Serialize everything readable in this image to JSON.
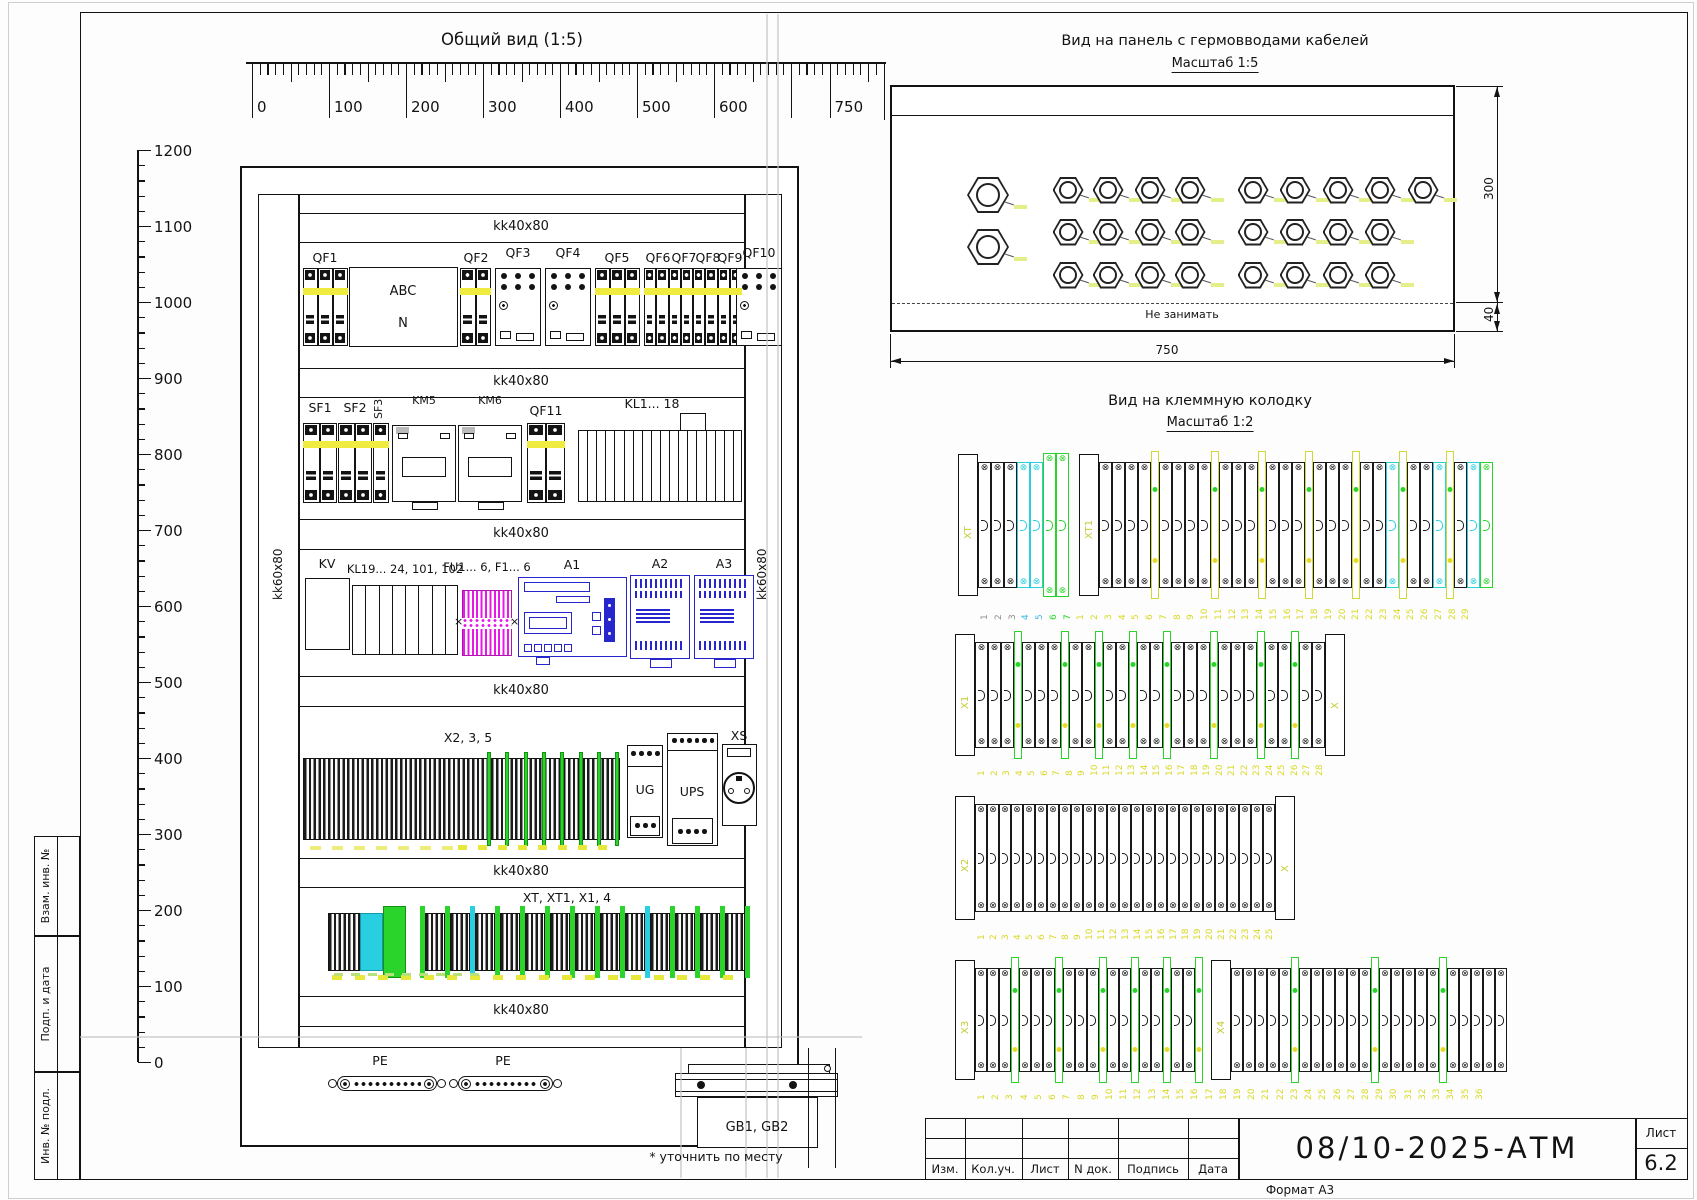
{
  "gv": {
    "title": "Общий вид (1:5)",
    "channel_h": "kk40x80",
    "channel_v": "kk60x80",
    "h_ruler": [
      "0",
      "100",
      "200",
      "300",
      "400",
      "500",
      "600",
      "750"
    ],
    "v_ruler": [
      "1200",
      "1100",
      "1000",
      "900",
      "800",
      "700",
      "600",
      "500",
      "400",
      "300",
      "200",
      "100",
      "0"
    ],
    "qf1": "QF1",
    "qf2": "QF2",
    "qf3": "QF3",
    "qf4": "QF4",
    "qf5": "QF5",
    "qf6": "QF6",
    "qf7": "QF7",
    "qf8": "QF8",
    "qf9": "QF9",
    "qf10": "QF10",
    "qf11": "QF11",
    "phase_a": "ABC",
    "phase_n": "N",
    "sf1": "SF1",
    "sf2": "SF2",
    "sf3": "SF3",
    "km5": "KM5",
    "km6": "KM6",
    "kl_1_18": "KL1... 18",
    "kv": "KV",
    "kl_19": "KL19... 24, 101, 102",
    "fu": "FU1... 6, F1... 6",
    "a1": "A1",
    "a2": "A2",
    "a3": "A3",
    "x235": "X2, 3, 5",
    "ug": "UG",
    "ups": "UPS",
    "xs": "XS",
    "xt_row": "XT, XT1, X1, 4",
    "pe": "PE",
    "gb": "GB1, GB2",
    "footnote": "* уточнить по месту"
  },
  "gland": {
    "title": "Вид на панель с гермовводами кабелей",
    "scale": "Масштаб 1:5",
    "keep_out": "Не занимать",
    "dim_width": "750",
    "dim_height": "300",
    "dim_flange": "40",
    "left_column_glands": 2,
    "middle_grid": {
      "cols": 4,
      "rows": 3
    },
    "right_grid_rows": [
      5,
      4,
      4
    ]
  },
  "tv": {
    "title": "Вид на клеммную колодку",
    "scale": "Масштаб 1:2",
    "strips": [
      {
        "name": "XT / XT1",
        "div_color": "#cfd83a",
        "tokens": [
          {
            "k": "bracket",
            "t": "XT"
          },
          {
            "k": "cells",
            "c": "black",
            "n": 3
          },
          {
            "k": "cells",
            "c": "cyan",
            "n": 2
          },
          {
            "k": "cells",
            "c": "green",
            "n": 2,
            "tall": true
          },
          {
            "k": "gap",
            "w": 10
          },
          {
            "k": "bracket",
            "t": "XT1"
          },
          {
            "k": "cells",
            "c": "black",
            "n": 4
          },
          {
            "k": "div"
          },
          {
            "k": "cells",
            "c": "black",
            "n": 4
          },
          {
            "k": "div"
          },
          {
            "k": "cells",
            "c": "black",
            "n": 3
          },
          {
            "k": "div"
          },
          {
            "k": "cells",
            "c": "black",
            "n": 3
          },
          {
            "k": "div"
          },
          {
            "k": "cells",
            "c": "black",
            "n": 3
          },
          {
            "k": "div"
          },
          {
            "k": "cells",
            "c": "black",
            "n": 2
          },
          {
            "k": "cells",
            "c": "cyan",
            "n": 1
          },
          {
            "k": "div"
          },
          {
            "k": "cells",
            "c": "black",
            "n": 2
          },
          {
            "k": "cells",
            "c": "cyan",
            "n": 1
          },
          {
            "k": "div"
          },
          {
            "k": "cells",
            "c": "black",
            "n": 1
          },
          {
            "k": "cells",
            "c": "cyan",
            "n": 1
          },
          {
            "k": "cells",
            "c": "green",
            "n": 1
          }
        ],
        "numbers": [
          {
            "from": 1,
            "to": 3,
            "color": "#8f8f8f"
          },
          {
            "from": 4,
            "to": 5,
            "color": "#3bb7e8"
          },
          {
            "from": 6,
            "to": 7,
            "color": "#2bd42b"
          },
          {
            "from": 1,
            "to": 29,
            "color": "#d9d926"
          }
        ]
      },
      {
        "name": "X1",
        "div_color": "#2bd42b",
        "tokens": [
          {
            "k": "bracket",
            "t": "X1"
          },
          {
            "k": "cells",
            "c": "black",
            "n": 3
          },
          {
            "k": "div"
          },
          {
            "k": "cells",
            "c": "black",
            "n": 3
          },
          {
            "k": "div"
          },
          {
            "k": "cells",
            "c": "black",
            "n": 2
          },
          {
            "k": "div"
          },
          {
            "k": "cells",
            "c": "black",
            "n": 2
          },
          {
            "k": "div"
          },
          {
            "k": "cells",
            "c": "black",
            "n": 2
          },
          {
            "k": "div"
          },
          {
            "k": "cells",
            "c": "black",
            "n": 3
          },
          {
            "k": "div"
          },
          {
            "k": "cells",
            "c": "black",
            "n": 3
          },
          {
            "k": "div"
          },
          {
            "k": "cells",
            "c": "black",
            "n": 2
          },
          {
            "k": "div"
          },
          {
            "k": "cells",
            "c": "black",
            "n": 2
          },
          {
            "k": "bracket",
            "t": "X"
          }
        ],
        "numbers": [
          {
            "from": 1,
            "to": 28,
            "color": "#d9d926"
          }
        ]
      },
      {
        "name": "X2",
        "div_color": "#2bd42b",
        "tokens": [
          {
            "k": "bracket",
            "t": "X2"
          },
          {
            "k": "cells",
            "c": "black",
            "n": 25
          },
          {
            "k": "bracket",
            "t": "X"
          }
        ],
        "numbers": [
          {
            "from": 1,
            "to": 25,
            "color": "#d9d926"
          }
        ]
      },
      {
        "name": "X3 / X4",
        "div_color": "#2bd42b",
        "tokens": [
          {
            "k": "bracket",
            "t": "X3"
          },
          {
            "k": "cells",
            "c": "black",
            "n": 3
          },
          {
            "k": "div"
          },
          {
            "k": "cells",
            "c": "black",
            "n": 3
          },
          {
            "k": "div"
          },
          {
            "k": "cells",
            "c": "black",
            "n": 3
          },
          {
            "k": "div"
          },
          {
            "k": "cells",
            "c": "black",
            "n": 2
          },
          {
            "k": "div"
          },
          {
            "k": "cells",
            "c": "black",
            "n": 2
          },
          {
            "k": "div"
          },
          {
            "k": "cells",
            "c": "black",
            "n": 2
          },
          {
            "k": "div"
          },
          {
            "k": "gap",
            "w": 8
          },
          {
            "k": "bracket",
            "t": "X4"
          },
          {
            "k": "cells",
            "c": "black",
            "n": 5
          },
          {
            "k": "div"
          },
          {
            "k": "cells",
            "c": "black",
            "n": 6
          },
          {
            "k": "div"
          },
          {
            "k": "cells",
            "c": "black",
            "n": 5
          },
          {
            "k": "div"
          },
          {
            "k": "cells",
            "c": "black",
            "n": 5
          }
        ],
        "numbers": [
          {
            "from": 1,
            "to": 36,
            "color": "#d9d926"
          }
        ]
      }
    ]
  },
  "stamps": {
    "items": [
      "Взам. инв. №",
      "Подп. и дата",
      "Инв. № подл."
    ]
  },
  "title_block": {
    "cols": [
      "Изм.",
      "Кол.уч.",
      "Лист",
      "N док.",
      "Подпись",
      "Дата"
    ],
    "doc": "08/10-2025-АТМ",
    "sheet_label": "Лист",
    "sheet_no": "6.2",
    "format": "Формат А3"
  },
  "colors": {
    "yellow_stripe": "#f0ec3f",
    "green": "#2bd42b",
    "cyan": "#29cfe0",
    "magenta": "#e818e8",
    "device_blue": "#2626cc",
    "tag": "#e4ef8a",
    "num_yellow": "#d9d926"
  }
}
